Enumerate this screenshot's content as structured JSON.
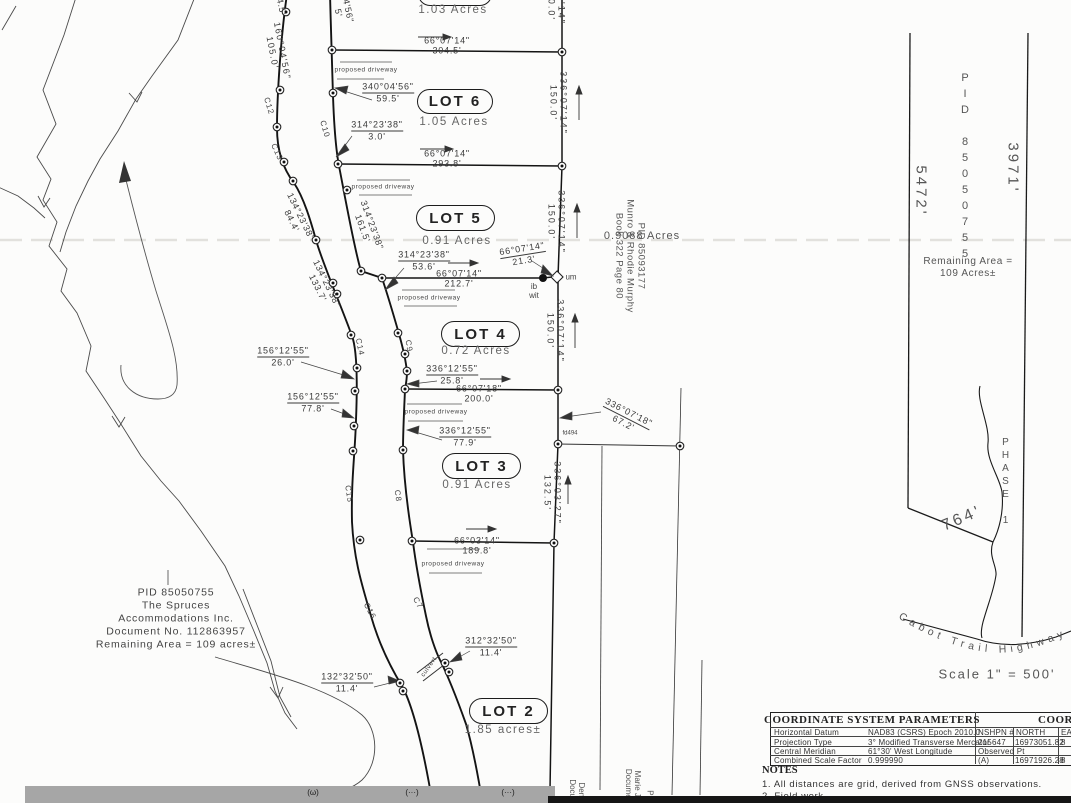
{
  "lots": [
    {
      "name": "",
      "area": "1.03 Acres"
    },
    {
      "name": "LOT 6",
      "area": "1.05 Acres"
    },
    {
      "name": "LOT 5",
      "area": "0.91 Acres"
    },
    {
      "name": "LOT 4",
      "area": "0.72 Acres"
    },
    {
      "name": "LOT 3",
      "area": "0.91 Acres"
    },
    {
      "name": "LOT 2",
      "area": "1.85 acres±"
    }
  ],
  "dims": [
    {
      "b": "66°07'14\"",
      "d": "304.5'"
    },
    {
      "b": "340°04'56\"",
      "d": "59.5'"
    },
    {
      "b": "314°23'38\"",
      "d": "3.0'"
    },
    {
      "b": "66°07'14\"",
      "d": "293.8'"
    },
    {
      "b": "314°23'38\"",
      "d": "161.5'"
    },
    {
      "b": "134°23'38\"",
      "d": "84.4'"
    },
    {
      "b": "134°23'38\"",
      "d": "133.7'"
    },
    {
      "b": "314°23'38\"",
      "d": "53.6'"
    },
    {
      "b": "66°07'14\"",
      "d": "212.7'"
    },
    {
      "b": "66°07'14\"",
      "d": "21.3'"
    },
    {
      "b": "156°12'55\"",
      "d": "26.0'"
    },
    {
      "b": "156°12'55\"",
      "d": "77.8'"
    },
    {
      "b": "336°12'55\"",
      "d": "25.8'"
    },
    {
      "b": "66°07'18\"",
      "d": "200.0'"
    },
    {
      "b": "336°12'55\"",
      "d": "77.9'"
    },
    {
      "b": "66°03'14\"",
      "d": "189.8'"
    },
    {
      "b": "312°32'50\"",
      "d": "11.4'"
    },
    {
      "b": "132°32'50\"",
      "d": "11.4'"
    },
    {
      "b": "336°07'18\"",
      "d": "67.2'"
    },
    {
      "b": "336°03'27\"",
      "d": "132.5'"
    },
    {
      "b": "336°07'14\"",
      "d": "150.0'"
    },
    {
      "b": "336°07'14\"",
      "d": "150.0'"
    },
    {
      "b": "336°07'14\"",
      "d": "150.0'"
    },
    {
      "b": "160°04'56\"",
      "d": "105.0'"
    },
    {
      "b": "7'14\"",
      "d": "0.0'"
    },
    {
      "b": "4'56\"",
      "d": "5'"
    },
    {
      "b": "4.5'",
      "d": ""
    }
  ],
  "curve_labels": [
    "C12",
    "C13",
    "C10",
    "C14",
    "C9",
    "C15",
    "C8",
    "C16",
    "C7"
  ],
  "labels": {
    "proposed_driveway": "proposed driveway",
    "culvert": "culvert",
    "ib": "ib",
    "wit": "wit",
    "um": "um",
    "fd": "fd494",
    "murphy_area": "0.9088 Acres",
    "murphy_pid": "PID 85093177",
    "murphy_owner": "Munro & Rhodie Murphy",
    "murphy_book": "Book 322 Page 80"
  },
  "left_block": {
    "pid": "PID 85050755",
    "owner1": "The Spruces",
    "owner2": "Accommodations Inc.",
    "doc": "Document No. 112863957",
    "remaining": "Remaining Area = 109 acres±"
  },
  "right_parcel": {
    "pid": "PID 85050755",
    "west_len": "5472'",
    "east_len": "3971'",
    "remaining1": "Remaining Area =",
    "remaining2": "109 Acres±",
    "south_len": "764'",
    "phase": "PHASE 1",
    "highway": "Cabot Trail Highway",
    "scale": "Scale 1\" = 500'"
  },
  "bottom_labels": {
    "p1l1": "Denn",
    "p1l2": "Docum",
    "p2l1": "Marie Je",
    "p2l2": "Documen",
    "p3": "PI",
    "g1": "(ω)",
    "g2": "(···)",
    "g3": "(···)"
  },
  "table": {
    "title": "COORDINATE SYSTEM PARAMETERS",
    "rows": [
      {
        "k": "Horizontal Datum",
        "v": "NAD83 (CSRS) Epoch 2010.0"
      },
      {
        "k": "Projection Type",
        "v": "3° Modified Transverse Mercator"
      },
      {
        "k": "Central Meridian",
        "v": "61°30' West Longitude"
      },
      {
        "k": "Combined Scale Factor",
        "v": "0.999990"
      }
    ],
    "coord_title": "COORDIN",
    "coord_headers": [
      "NSHPN #",
      "NORTH",
      "EA"
    ],
    "coord_rows": [
      [
        "215647",
        "16973051.82",
        "8"
      ],
      [
        "Observed Pt",
        "",
        ""
      ],
      [
        "(A)",
        "16971926.28",
        "8"
      ]
    ]
  },
  "notes": {
    "title": "NOTES",
    "n1": "1.   All distances are grid, derived from GNSS observations.",
    "n2": "2.   Field work"
  }
}
